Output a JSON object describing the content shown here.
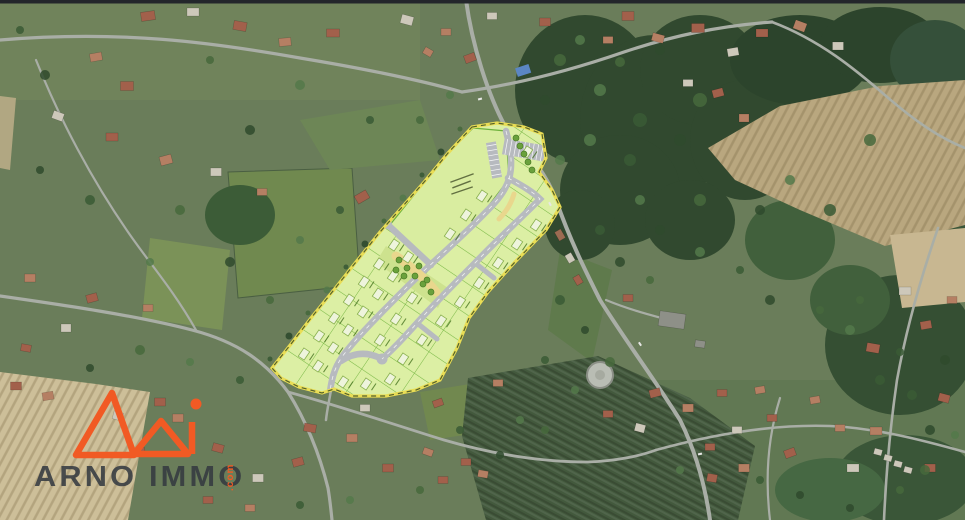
{
  "watermark": {
    "brand": "ARNO IMMO",
    "tld": ".com"
  },
  "logo": {
    "color": "#f15a24"
  },
  "overlay": {
    "fill": "#dcefa4",
    "parcel_line": "#6fb23c",
    "boundary_yellow": "#e9dd55",
    "boundary_dash": "#55622b",
    "road_gray": "#b7babf",
    "path_tan": "#e9d78d",
    "building_fill": "#eef4dc"
  },
  "terrain": {
    "base_green": "#6a7d5a",
    "forest_green": "#31492f",
    "field_tan": "#c3b28c",
    "road_gray": "#a9aea6",
    "top_bar": "#23262b"
  }
}
